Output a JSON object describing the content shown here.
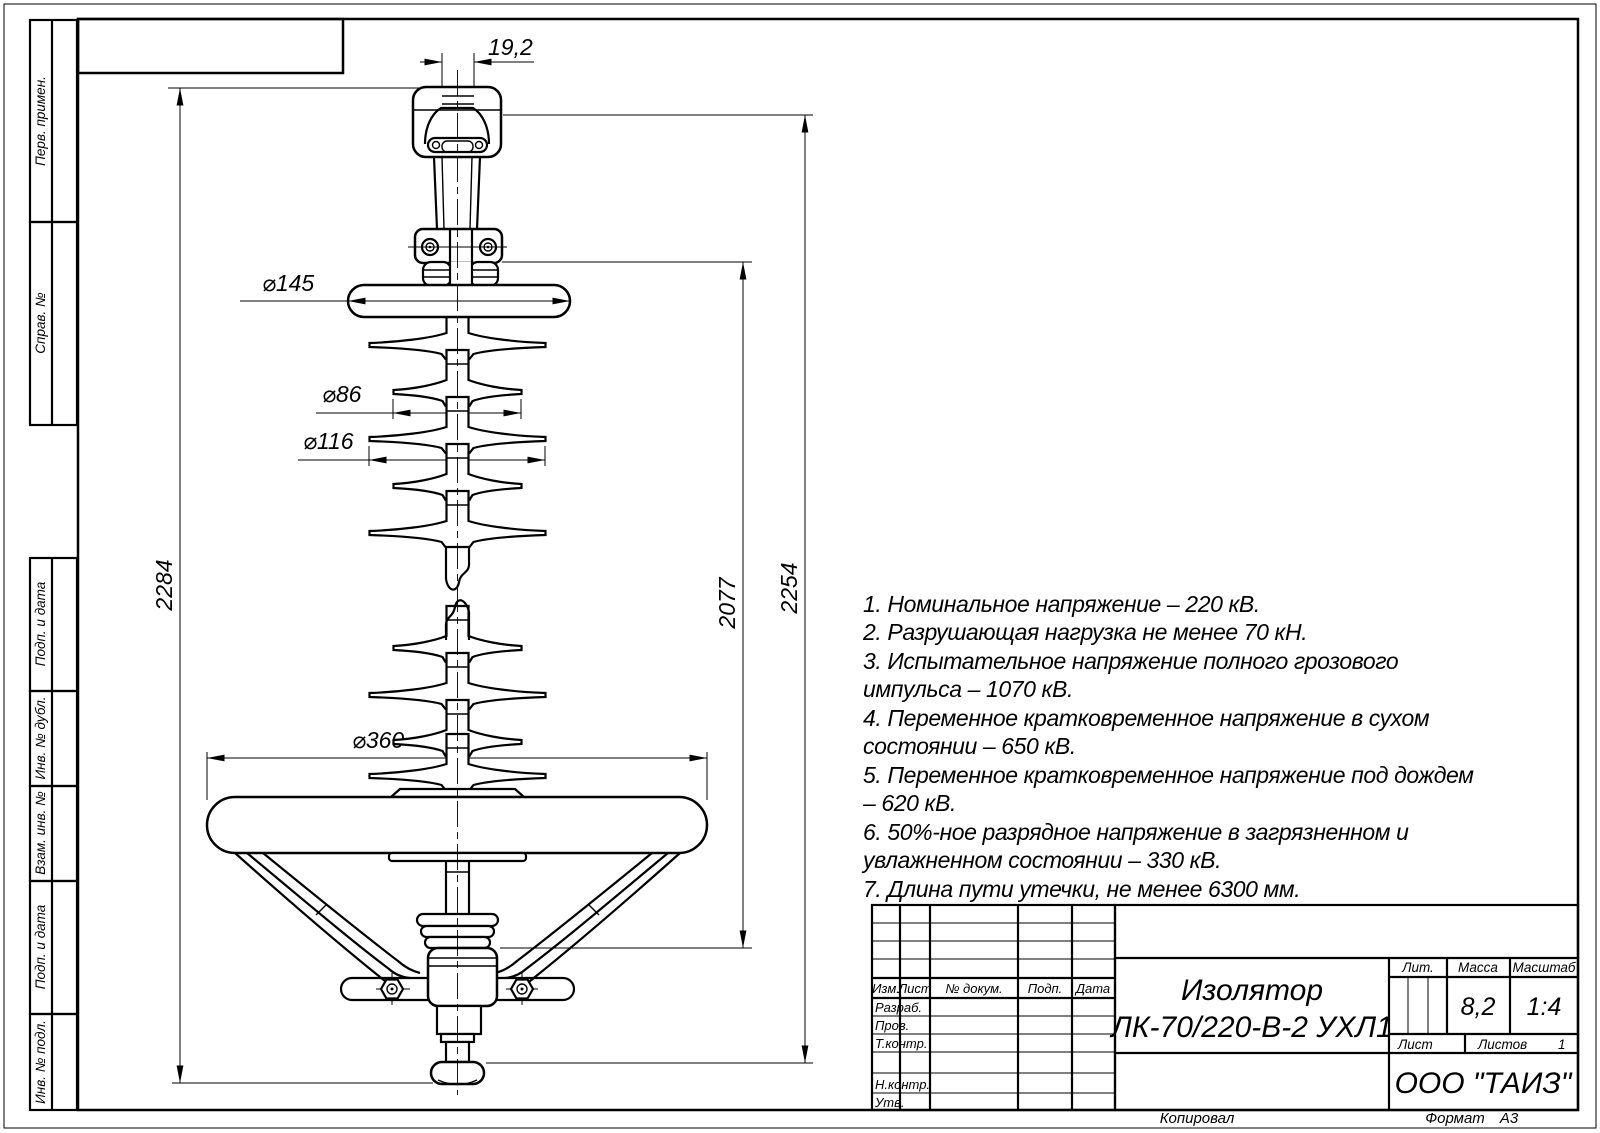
{
  "sheet": {
    "copied": "Копировал",
    "format_label": "Формат",
    "format_value": "А3"
  },
  "side_strip": {
    "labels": [
      "Перв. примен.",
      "Справ. №",
      "Подп. и дата",
      "Инв. № дубл.",
      "Взам. инв. №",
      "Подп. и дата",
      "Инв. № подл."
    ]
  },
  "dimensions": {
    "slot_width": "19,2",
    "top_ring_diameter": "⌀145",
    "small_shed_diameter": "⌀86",
    "large_shed_diameter": "⌀116",
    "bottom_ring_diameter": "⌀360",
    "overall_height": "2284",
    "insulation_height": "2077",
    "structural_height": "2254"
  },
  "notes": {
    "lines": [
      "1. Номинальное напряжение – 220 кВ.",
      "2. Разрушающая нагрузка не менее 70 кН.",
      "3. Испытательное напряжение полного грозового",
      "импульса – 1070 кВ.",
      "4. Переменное кратковременное напряжение  в сухом",
      "состоянии – 650 кВ.",
      "5. Переменное кратковременное напряжение под дождем",
      "– 620 кВ.",
      "6. 50%-ное разрядное напряжение в загрязненном и",
      "увлажненном состоянии – 330 кВ.",
      "7. Длина пути утечки, не менее 6300 мм."
    ]
  },
  "title_block": {
    "product_title_line1": "Изолятор",
    "product_title_line2": "ЛК-70/220-В-2 УХЛ1",
    "company": "ООО \"ТАИЗ\"",
    "col_izm": "Изм.",
    "col_list": "Лист",
    "col_doc": "№ докум.",
    "col_podp": "Подп.",
    "col_data": "Дата",
    "row_razrab": "Разраб.",
    "row_prov": "Пров.",
    "row_tkontr": "Т.контр.",
    "row_nkontr": "Н.контр.",
    "row_utv": "Утв.",
    "lit_label": "Лит.",
    "mass_label": "Масса",
    "scale_label": "Масштаб",
    "mass_value": "8,2",
    "scale_value": "1:4",
    "sheet_label": "Лист",
    "sheets_label": "Листов",
    "sheets_value": "1"
  }
}
